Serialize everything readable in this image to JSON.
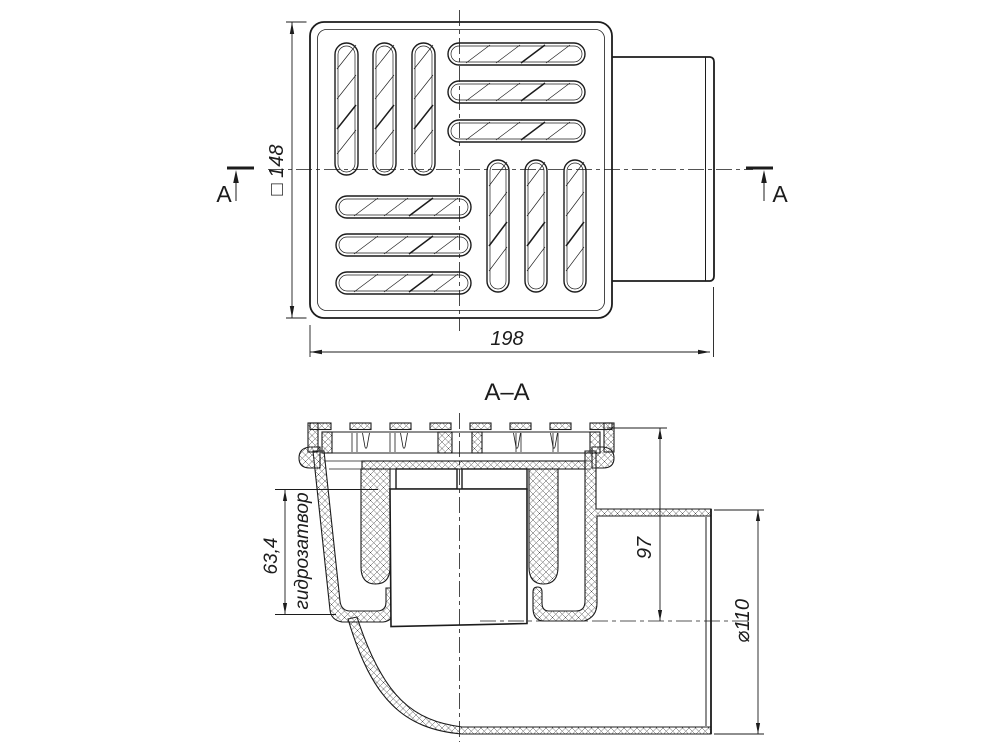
{
  "drawing": {
    "colors": {
      "line": "#1c1c1c",
      "background": "#ffffff"
    },
    "top_view": {
      "section_marker_left": "A",
      "section_marker_right": "A",
      "dim_grate_side": "□ 148",
      "dim_overall_length": "198"
    },
    "section_view": {
      "title": "A–A",
      "dim_water_seal_height": "63,4",
      "water_seal_label": "гидрозатвор",
      "dim_top_to_outlet_axis": "97",
      "dim_outlet_diameter": "⌀110"
    }
  }
}
